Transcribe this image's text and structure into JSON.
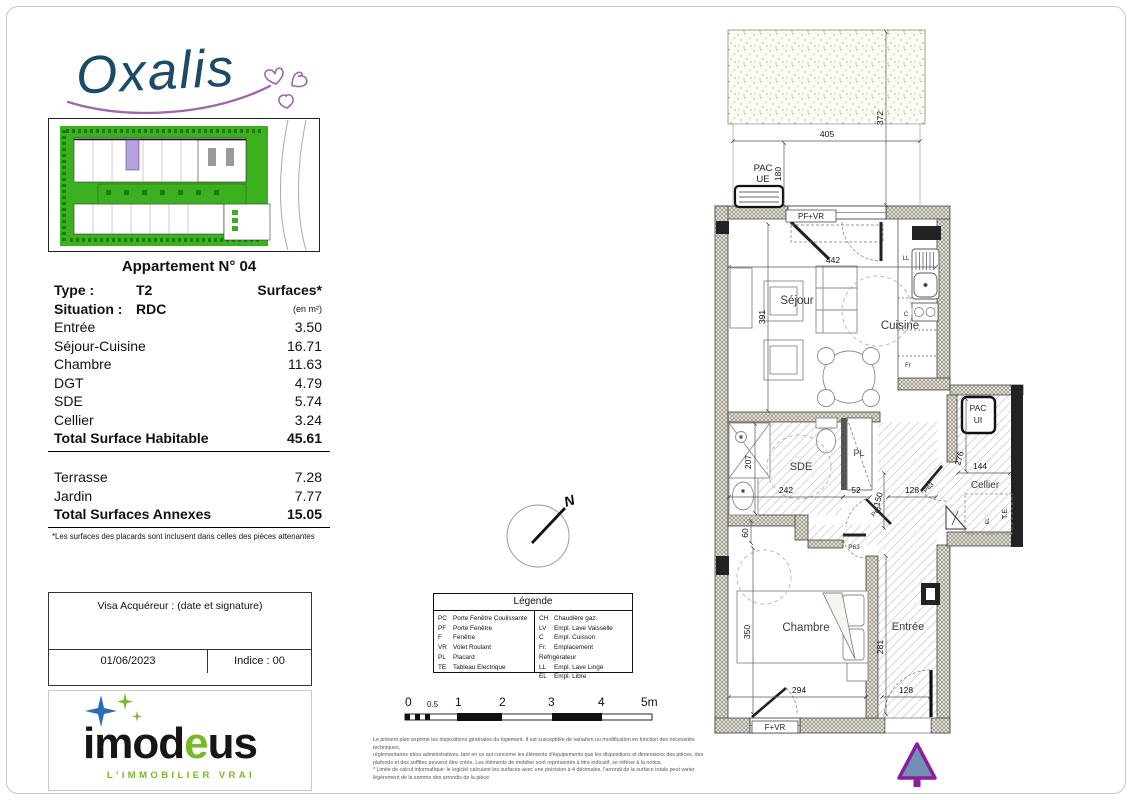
{
  "brand": {
    "name": "Oxalis"
  },
  "developer": {
    "logo_left": "imod",
    "logo_accent": "e",
    "logo_right": "us",
    "tagline": "L'IMMOBILIER VRAI"
  },
  "apartment": {
    "title": "Appartement N° 04",
    "type_label": "Type :",
    "type_value": "T2",
    "surfaces_header": "Surfaces*",
    "situation_label": "Situation :",
    "situation_value": "RDC",
    "surfaces_unit": "(en m²)",
    "rows": [
      {
        "label": "Entrée",
        "value": "3.50"
      },
      {
        "label": "Séjour-Cuisine",
        "value": "16.71"
      },
      {
        "label": "Chambre",
        "value": "11.63"
      },
      {
        "label": "DGT",
        "value": "4.79"
      },
      {
        "label": "SDE",
        "value": "5.74"
      },
      {
        "label": "Cellier",
        "value": "3.24"
      }
    ],
    "total_habitable_label": "Total Surface Habitable",
    "total_habitable_value": "45.61",
    "annex_rows": [
      {
        "label": "Terrasse",
        "value": "7.28"
      },
      {
        "label": "Jardin",
        "value": "7.77"
      }
    ],
    "total_annexes_label": "Total Surfaces Annexes",
    "total_annexes_value": "15.05",
    "footnote": "*Les surfaces des placards sont inclusent dans celles des pièces attenantes"
  },
  "visa": {
    "title": "Visa Acquéreur : (date et signature)",
    "date": "01/06/2023",
    "indice": "Indice : 00"
  },
  "legend": {
    "title": "Légende",
    "left": [
      {
        "abbr": "PC",
        "label": "Porte Fenêtre Coulissante"
      },
      {
        "abbr": "PF",
        "label": "Porte Fenêtre"
      },
      {
        "abbr": "F",
        "label": "Fenêtre"
      },
      {
        "abbr": "VR",
        "label": "Volet Roulant"
      },
      {
        "abbr": "PL",
        "label": "Placard"
      },
      {
        "abbr": "TE",
        "label": "Tableau Electrique"
      }
    ],
    "right": [
      {
        "abbr": "CH",
        "label": "Chaudière gaz."
      },
      {
        "abbr": "LV",
        "label": "Empl. Lave Vaisselle"
      },
      {
        "abbr": "C",
        "label": "Empl. Cuisson"
      },
      {
        "abbr": "Fr.",
        "label": "Emplacement Réfrigérateur"
      },
      {
        "abbr": "LL",
        "label": "Empl. Lave Linge"
      },
      {
        "abbr": "EL",
        "label": "Empl. Libre"
      }
    ]
  },
  "scalebar": {
    "labels": [
      "0",
      "0.5",
      "1",
      "2",
      "3",
      "4",
      "5m"
    ]
  },
  "disclaimer": {
    "lines": [
      "Le présent plan exprime les dispositions générales du logement. Il est susceptible de variation ou modification en fonction des nécessités techniques,",
      "réglementaires et/ou administratives, tant en ce qui concerne les éléments d'équipements que les dispositions et dimensions des pièces, des",
      "plafonds et des soffites peuvent être créés. Les éléments de mobilier sont représentés à titre indicatif, se référer à la notice.",
      "* Limite de calcul informatique: le logiciel calculent les surfaces avec une précision à 4 décimales, l'arrondi de la surface totale peut varier",
      "légèrement de la somme des arrondis de la pièce."
    ]
  },
  "compass": {
    "north": "N"
  },
  "floorplan": {
    "rooms": {
      "sejour": "Séjour",
      "cuisine": "Cuisine",
      "sde": "SDE",
      "pl": "PL",
      "chambre": "Chambre",
      "entree": "Entrée",
      "cellier": "Cellier"
    },
    "equipment": {
      "pac_ue_line1": "PAC",
      "pac_ue_line2": "UE",
      "pac_ui_line1": "PAC",
      "pac_ui_line2": "UI",
      "ll": "LL",
      "c": "C",
      "fr": "Fr",
      "te": "T.E.",
      "el": "EL"
    },
    "openings": {
      "pf_vr": "PF+VR",
      "f_vr": "F+VR",
      "door_ref": "P63"
    },
    "dims": {
      "garden_width": "405",
      "garden_height": "372",
      "terrace_height": "180",
      "sejour_width": "442",
      "sejour_height": "391",
      "shower": "207",
      "sde_width": "242",
      "pl_width": "52",
      "dgt_height": "150",
      "dgt_width": "128",
      "sde_offset": "60",
      "chambre_height": "350",
      "chambre_width": "294",
      "entree_height": "281",
      "entree_width": "128",
      "cellier_height": "276",
      "cellier_width": "144"
    }
  },
  "colors": {
    "accent_purple": "#8b1f9b",
    "arrow_fill": "#7291b4",
    "site_green": "#3cb11f",
    "unit_highlight": "#b4a3de",
    "oxalis_blue": "#1d4a66",
    "oxalis_purple": "#9d66ad",
    "imodeus_green": "#79b829",
    "imodeus_blue": "#2a6cb8"
  }
}
